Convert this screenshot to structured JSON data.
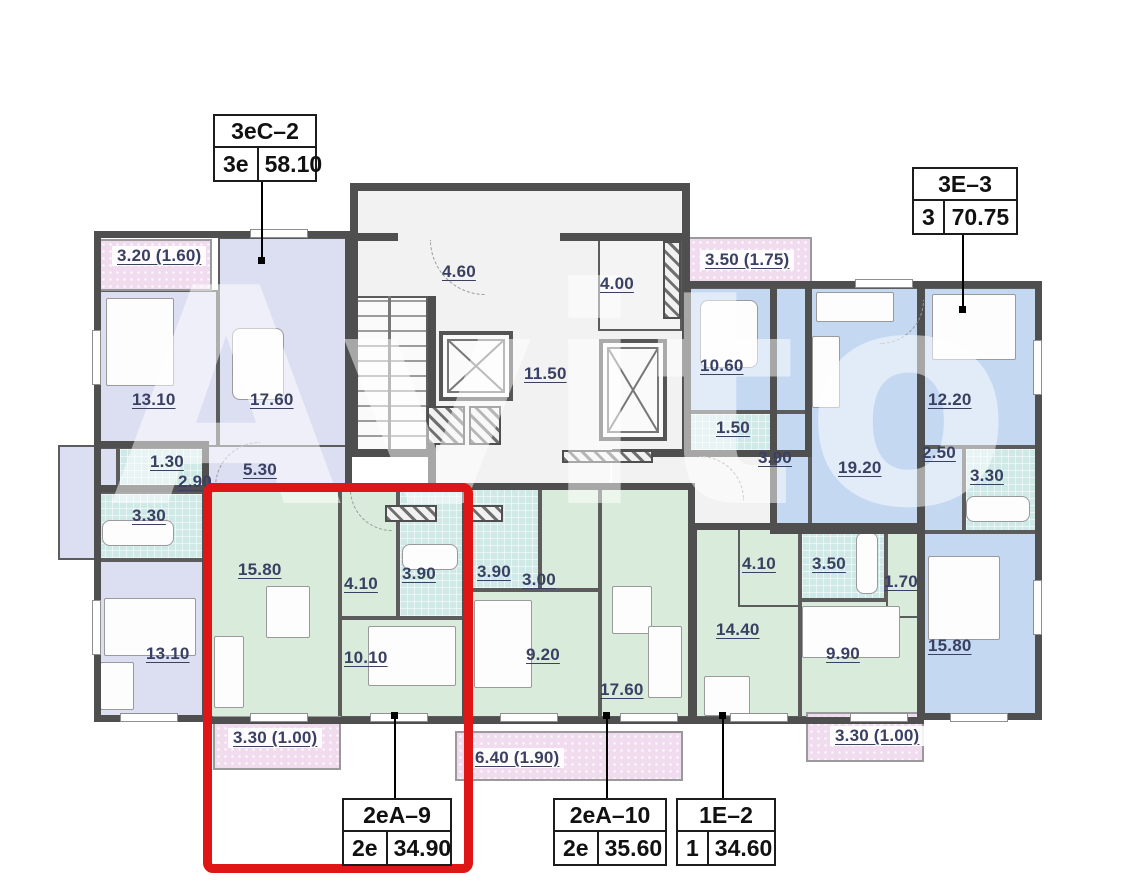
{
  "watermark": "Avito",
  "palette": {
    "apartment_lavender": "#dcdef1",
    "apartment_blue": "#c5d8f1",
    "apartment_green": "#d9ecdb",
    "wet_room_teal": "#cfe9e7",
    "balcony_pink": "#f0dcee",
    "wall": "#4f4f4f",
    "highlight_red": "#e01515",
    "room_label_text": "#3a4062"
  },
  "highlight": {
    "apartment": "2еА–9"
  },
  "apartments": {
    "a3es2": {
      "name": "3еС–2",
      "rooms": "3е",
      "area": "58.10"
    },
    "a3e3": {
      "name": "3Е–3",
      "rooms": "3",
      "area": "70.75"
    },
    "a2ea9": {
      "name": "2еА–9",
      "rooms": "2е",
      "area": "34.90"
    },
    "a2ea10": {
      "name": "2еА–10",
      "rooms": "2е",
      "area": "35.60"
    },
    "a1e2": {
      "name": "1Е–2",
      "rooms": "1",
      "area": "34.60"
    }
  },
  "room_labels": {
    "lav_balcony": "3.20 (1.60)",
    "lav_bedroom1": "13.10",
    "lav_living": "17.60",
    "lav_wc": "1.30",
    "lav_hall": "5.30",
    "lav_hall2": "2.90",
    "lav_bath": "3.30",
    "lav_bedroom2": "13.10",
    "g9_kitchen_living": "15.80",
    "g9_hall": "4.10",
    "g9_bath": "3.90",
    "g9_bedroom": "10.10",
    "g9_balcony": "3.30 (1.00)",
    "g10_bath": "3.90",
    "g10_hall": "3.00",
    "g10_bedroom": "9.20",
    "g10_kitchen_living": "17.60",
    "g10_balcony": "6.40 (1.90)",
    "e2_hall": "4.10",
    "e2_bath": "3.50",
    "e2_wardrobe": "1.70",
    "e2_kitchen_living": "14.40",
    "e2_bedroom": "9.90",
    "e2_balcony": "3.30 (1.00)",
    "blue_balcony": "3.50 (1.75)",
    "blue_kitchen": "10.60",
    "blue_wc": "1.50",
    "blue_hall": "3.90",
    "blue_living": "19.20",
    "blue_bedroom1": "12.20",
    "blue_hall2": "2.50",
    "blue_bath": "3.30",
    "blue_bedroom2": "15.80",
    "core_lobby": "4.60",
    "core_room": "4.00",
    "core_corridor": "11.50"
  }
}
